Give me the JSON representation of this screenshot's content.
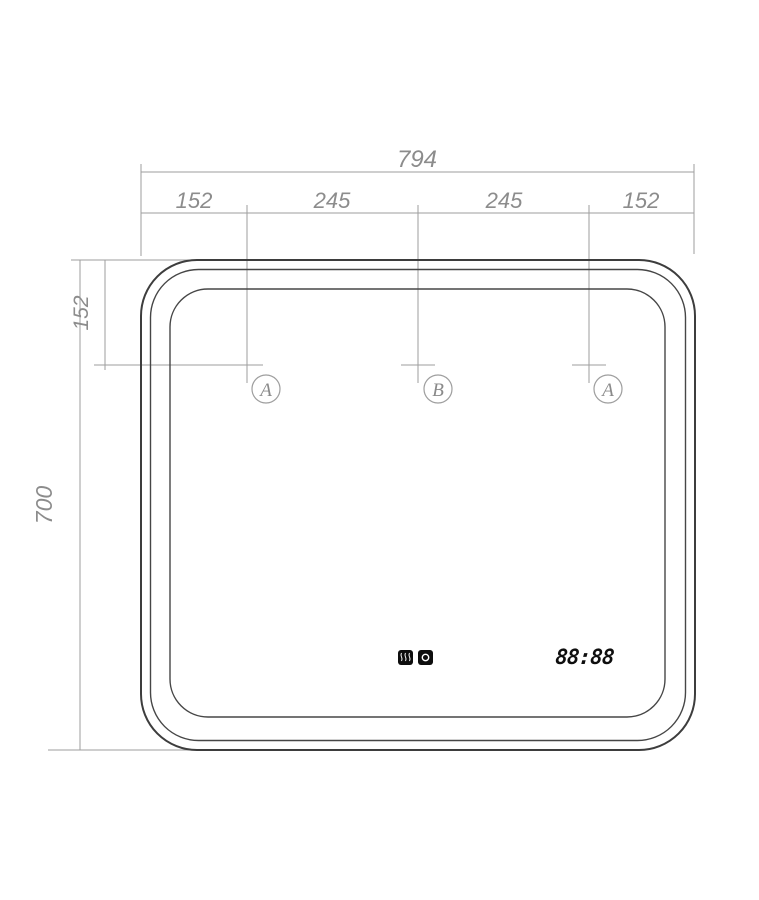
{
  "drawing": {
    "type": "technical-drawing-mirror-front-view",
    "dim_overall_width": "794",
    "dim_top_segments": [
      "152",
      "245",
      "245",
      "152"
    ],
    "dim_overall_height": "700",
    "dim_sensor_offset_top": "152",
    "markers": [
      {
        "label": "A"
      },
      {
        "label": "B"
      },
      {
        "label": "A"
      }
    ],
    "clock_display": "88:88",
    "icons": [
      {
        "name": "demister-touch-icon"
      },
      {
        "name": "light-power-touch-icon"
      }
    ],
    "colors": {
      "dimension_line": "#9e9e9e",
      "dimension_text": "#8c8c8c",
      "outline": "#3d3d3d",
      "display_elements": "#0e0e0e",
      "background": "#ffffff"
    }
  }
}
